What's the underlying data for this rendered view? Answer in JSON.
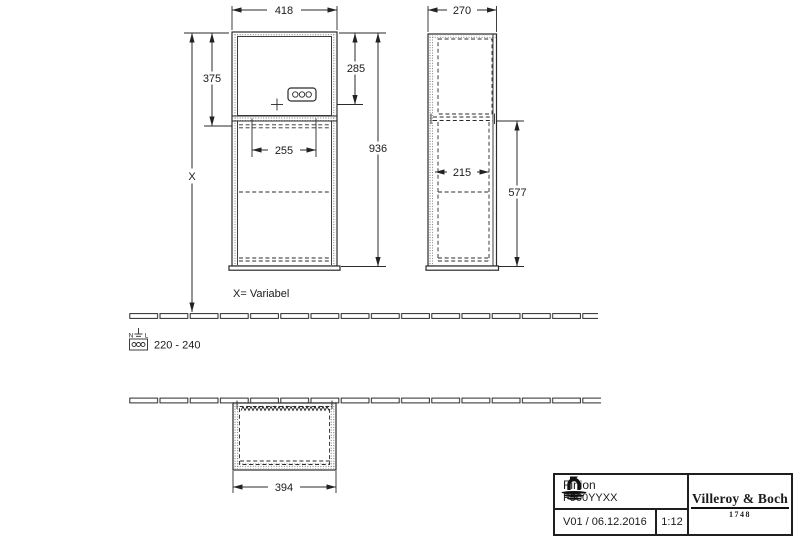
{
  "front_view": {
    "dim_width_top": "418",
    "dim_upper_height": "375",
    "dim_socket_height": "285",
    "dim_total_height": "936",
    "dim_inner_width": "255",
    "dim_variable_label": "X"
  },
  "side_view": {
    "dim_depth_top": "270",
    "dim_inner_depth": "215",
    "dim_lower_height": "577"
  },
  "plan_view": {
    "dim_width": "394"
  },
  "notes": {
    "variable_note": "X= Variabel",
    "voltage_range": "220 - 240",
    "socket_n": "N",
    "socket_l": "L"
  },
  "title_block": {
    "product_name": "Finion",
    "article_number": "F500YYXX",
    "version_date": "V01 / 06.12.2016",
    "scale": "1:12",
    "brand_name": "Villeroy & Boch",
    "brand_year": "1748"
  },
  "colors": {
    "line": "#2a2a2a",
    "background": "#ffffff"
  }
}
